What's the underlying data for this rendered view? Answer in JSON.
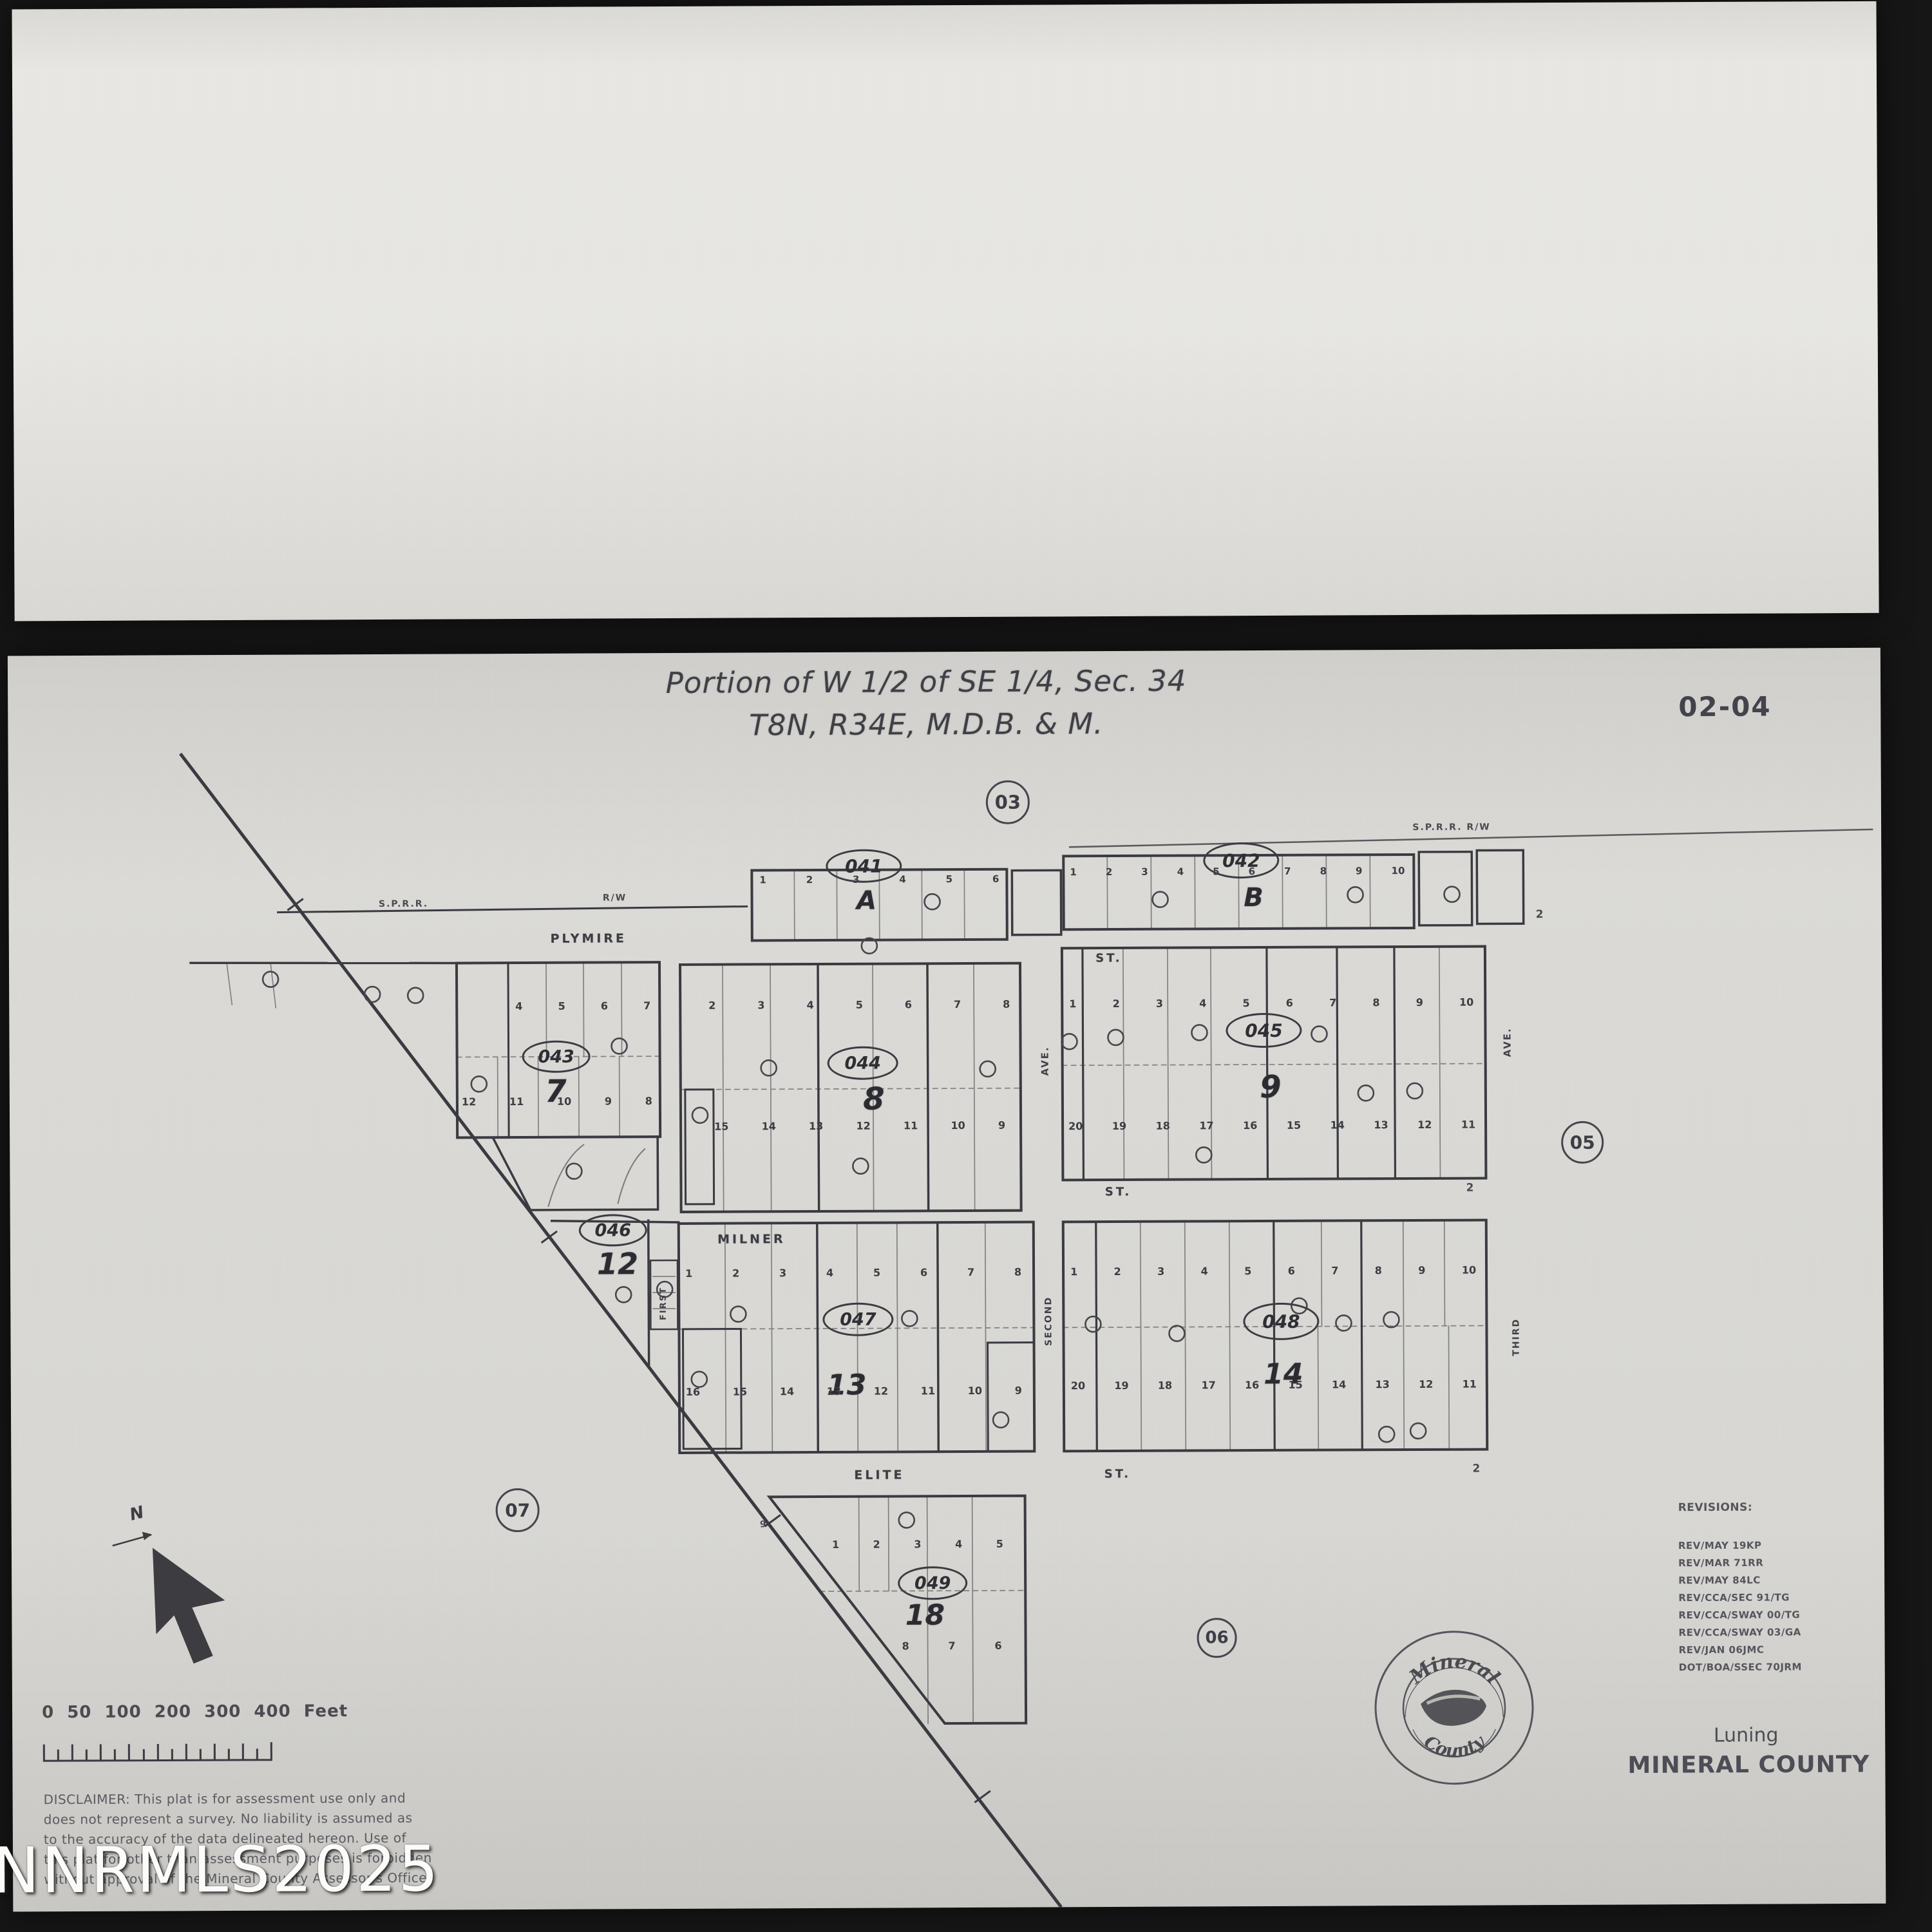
{
  "header": {
    "title_line1": "Portion of W 1/2 of SE 1/4, Sec. 34",
    "title_line2": "T8N, R34E, M.D.B. & M.",
    "sheet_number": "02-04"
  },
  "junctions": {
    "j03": "03",
    "j05": "05",
    "j06": "06",
    "j07": "07"
  },
  "streets": {
    "plymire": "PLYMIRE",
    "milner": "MILNER",
    "elite": "ELITE",
    "st_a": "ST.",
    "st_b": "ST.",
    "st_c": "ST.",
    "sprr": "S.P.R.R.",
    "rw": "R/W",
    "sprr_rw": "S.P.R.R.  R/W",
    "ave_a": "AVE.",
    "ave_b": "AVE.",
    "first": "FIRST",
    "second": "SECOND",
    "third": "THIRD",
    "end_b": "2",
    "end_9": "2",
    "end_14": "2",
    "end_elite_left": "9"
  },
  "blocks": {
    "a": {
      "parcel": "041",
      "label": "A",
      "lots_top": "1 2 3 4 5 6"
    },
    "b": {
      "parcel": "042",
      "label": "B",
      "lots_top": "1 2 3 4 5 6 7 8 9 10"
    },
    "b7": {
      "parcel": "043",
      "label": "7",
      "lots_top": "4 5 6 7",
      "lots_bottom": "12 11 10 9 8"
    },
    "b8": {
      "parcel": "044",
      "label": "8",
      "lots_top": "2 3 4 5 6 7 8",
      "lots_bottom": "15 14 13 12 11 10 9"
    },
    "b9": {
      "parcel": "045",
      "label": "9",
      "lots_top": "1 2 3 4 5 6 7 8 9 10",
      "lots_bottom": "20 19 18 17 16 15 14 13 12 11"
    },
    "b12": {
      "parcel": "046",
      "label": "12"
    },
    "b13": {
      "parcel": "047",
      "label": "13",
      "lots_top": "1 2 3 4 5 6 7 8",
      "lots_bottom": "16 15 14 13 12 11 10 9"
    },
    "b14": {
      "parcel": "048",
      "label": "14",
      "lots_top": "1 2 3 4 5 6 7 8 9 10",
      "lots_bottom": "20 19 18 17 16 15 14 13 12 11"
    },
    "b18": {
      "parcel": "049",
      "label": "18",
      "lots_top": "1 2 3 4 5",
      "lots_bottom": "8 7 6"
    }
  },
  "compass": {
    "north": "N"
  },
  "scalebar": {
    "label": "0  50 100   200   300   400 Feet"
  },
  "disclaimer": {
    "line1": "DISCLAIMER:  This plat is for assessment use only and",
    "line2": "does not represent a survey.  No liability  is assumed as",
    "line3": "to the accuracy of the data delineated hereon.   Use of",
    "line4": "this plat for other than assessment purposes is forbidden",
    "line5": "without approval of the Mineral County Assessor's Office."
  },
  "revisions": {
    "header": "REVISIONS:",
    "lines": [
      "REV/MAY 19KP",
      "REV/MAR 71RR",
      "REV/MAY 84LC",
      "REV/CCA/SEC 91/TG",
      "REV/CCA/SWAY 00/TG",
      "REV/CCA/SWAY 03/GA",
      "REV/JAN 06JMC",
      "DOT/BOA/SSEC 70JRM"
    ]
  },
  "seal": {
    "arc_top": "Mineral",
    "arc_bottom": "County"
  },
  "footer": {
    "city": "Luning",
    "county": "MINERAL COUNTY"
  },
  "watermark": "NNRMLS2025"
}
